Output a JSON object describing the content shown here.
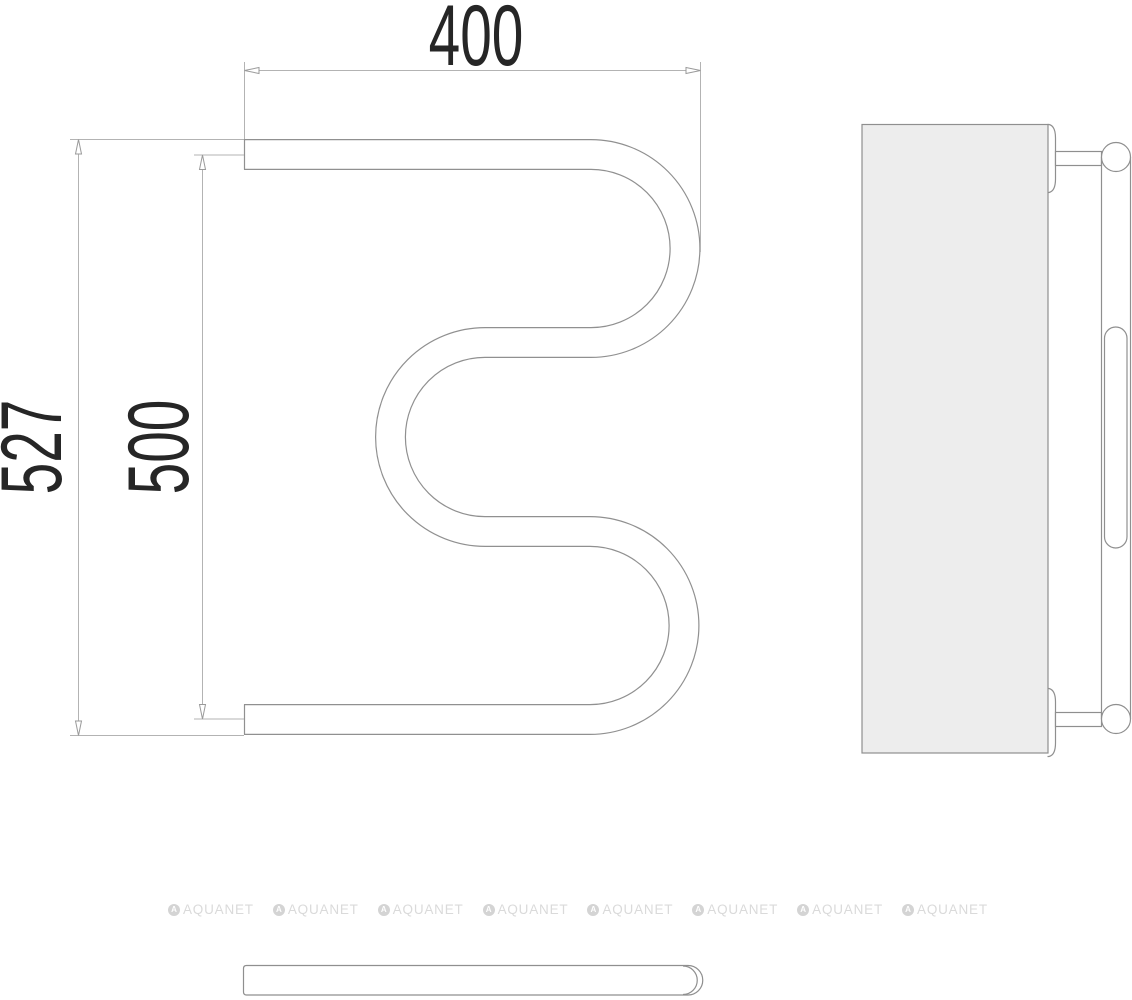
{
  "drawing": {
    "title": "towel-rail-technical-drawing",
    "dimensions": {
      "width_top": "400",
      "height_outer": "527",
      "height_axis": "500"
    },
    "watermark": {
      "brand": "AQUANET",
      "logo_letter": "A",
      "repeat": 8
    },
    "colors": {
      "object_line": "#909090",
      "dimension_line": "#b3b3b3",
      "text": "#262626",
      "panel_fill": "#ededed",
      "watermark": "#dadada"
    }
  }
}
